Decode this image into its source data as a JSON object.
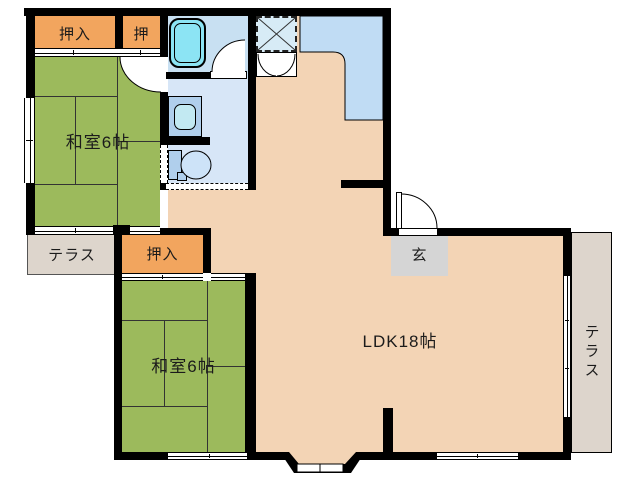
{
  "plan": {
    "type": "floor-plan",
    "rooms": {
      "oshiire1": "押入",
      "oshi": "押",
      "washitsu1": "和室6帖",
      "terrace_left": "テラス",
      "oshiire2": "押入",
      "washitsu2": "和室6帖",
      "ldk": "LDK18帖",
      "genkan": "玄",
      "terrace_right": "テラス"
    },
    "fixtures": [
      "bathtub",
      "washbasin",
      "toilet",
      "kitchen-sink",
      "kitchen-counter",
      "x-marked-storage",
      "double-door-closet",
      "entrance-door",
      "bay-window",
      "accordion-door"
    ],
    "colors": {
      "tatami_green": "#9cba5c",
      "closet_orange": "#f2a55e",
      "ldk_peach": "#f3d4b5",
      "wet_area_blue": "#d7e6f7",
      "bath_blue": "#c8e0f2",
      "tub_cyan": "#8ce4f4",
      "counter_blue": "#c0dcf4",
      "sink_cyan": "#a9eaf2",
      "terrace_gray": "#ddd5cc",
      "genkan_gray": "#d5d5d5",
      "wall_black": "#000000"
    }
  }
}
